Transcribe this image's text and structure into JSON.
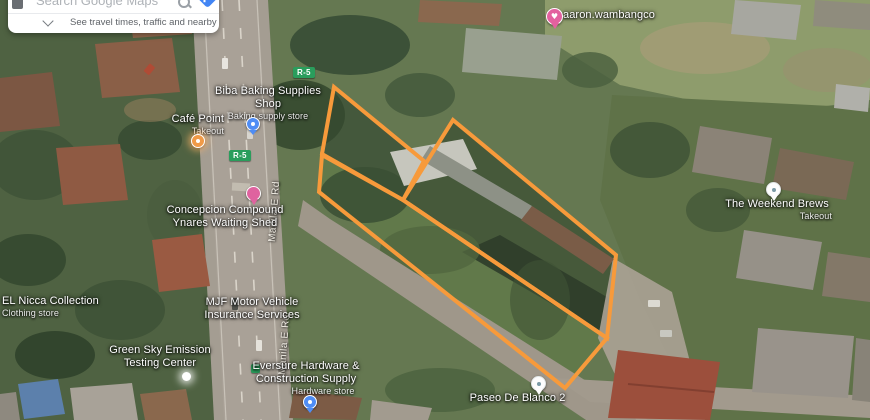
{
  "search_card": {
    "placeholder": "Search Google Maps",
    "travel_hint": "See travel times, traffic and nearby places"
  },
  "badges": {
    "r5_upper": "R-5",
    "r5_lower": "R-5"
  },
  "road_labels": {
    "upper": "Manila E Rd",
    "lower": "Manila E Rd"
  },
  "pois": {
    "biba": {
      "name": "Biba Baking Supplies Shop",
      "sub": "Baking supply store"
    },
    "cafe_point": {
      "name": "Café Point",
      "sub": "Takeout"
    },
    "concepcion": {
      "name": "Concepcion Compound Ynares Waiting Shed"
    },
    "aaron": {
      "name": "aaron.wambangco"
    },
    "weekend_brews": {
      "name": "The Weekend Brews",
      "sub": "Takeout"
    },
    "el_nicca": {
      "name": "EL Nicca Collection",
      "sub": "Clothing store"
    },
    "mjf": {
      "name": "MJF Motor Vehicle Insurance Services"
    },
    "green_sky": {
      "name": "Green Sky Emission Testing Center"
    },
    "eversure": {
      "name": "Eversure Hardware & Construction Supply",
      "sub": "Hardware store"
    },
    "paseo": {
      "name": "Paseo De Blanco 2"
    }
  },
  "parcels": {
    "stroke": "#F79A3B",
    "stroke_width": 4,
    "polygons": [
      {
        "id": "upper-strip",
        "points": "334,87 424,161 403,200 322,154"
      },
      {
        "id": "lower-strip",
        "points": "322,155 403,200 607,338 565,388 319,192"
      },
      {
        "id": "main-lot",
        "points": "453,120 616,255 607,338 403,200"
      }
    ]
  },
  "colors": {
    "parcel_orange": "#F79A3B",
    "route_badge_green": "#2A9D5C",
    "directions_blue": "#4285F4",
    "saved_pin_pink": "#E3619F",
    "shop_pin_blue": "#4F8DF5",
    "cafe_pin_orange": "#F09A47"
  }
}
